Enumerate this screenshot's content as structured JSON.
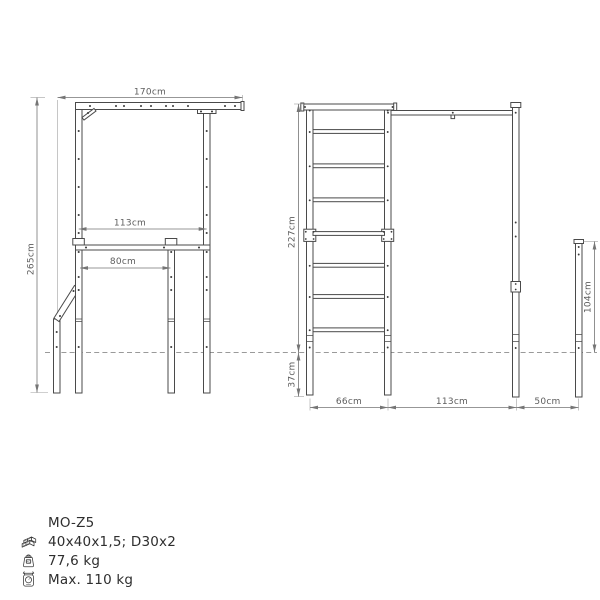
{
  "drawing": {
    "title": "outdoor-gym-technical-drawing",
    "dimensions": {
      "frame_width": "170cm",
      "frame_inner_width": "113cm",
      "dip_bar_width": "80cm",
      "frame_height": "265cm",
      "ladder_height": "227cm",
      "underground_depth": "37cm",
      "ladder_width": "66cm",
      "pullup_span": "113cm",
      "end_post_offset": "50cm",
      "end_post_height": "104cm"
    }
  },
  "info": {
    "model": "MO-Z5",
    "profile_spec": "40x40x1,5; D30x2",
    "weight": "77,6 kg",
    "max_load": "Max. 110 kg"
  },
  "icons": {
    "profile_spec": "profiles-stack-icon",
    "weight": "kg-weight-icon",
    "max_load": "scale-icon"
  },
  "colors": {
    "background": "#ffffff",
    "structure_line": "#4a4a4a",
    "dimension_line": "#757575",
    "dimension_text": "#5d5d5d",
    "ground_line": "#9a9a9a",
    "info_text": "#2e2e2e"
  }
}
